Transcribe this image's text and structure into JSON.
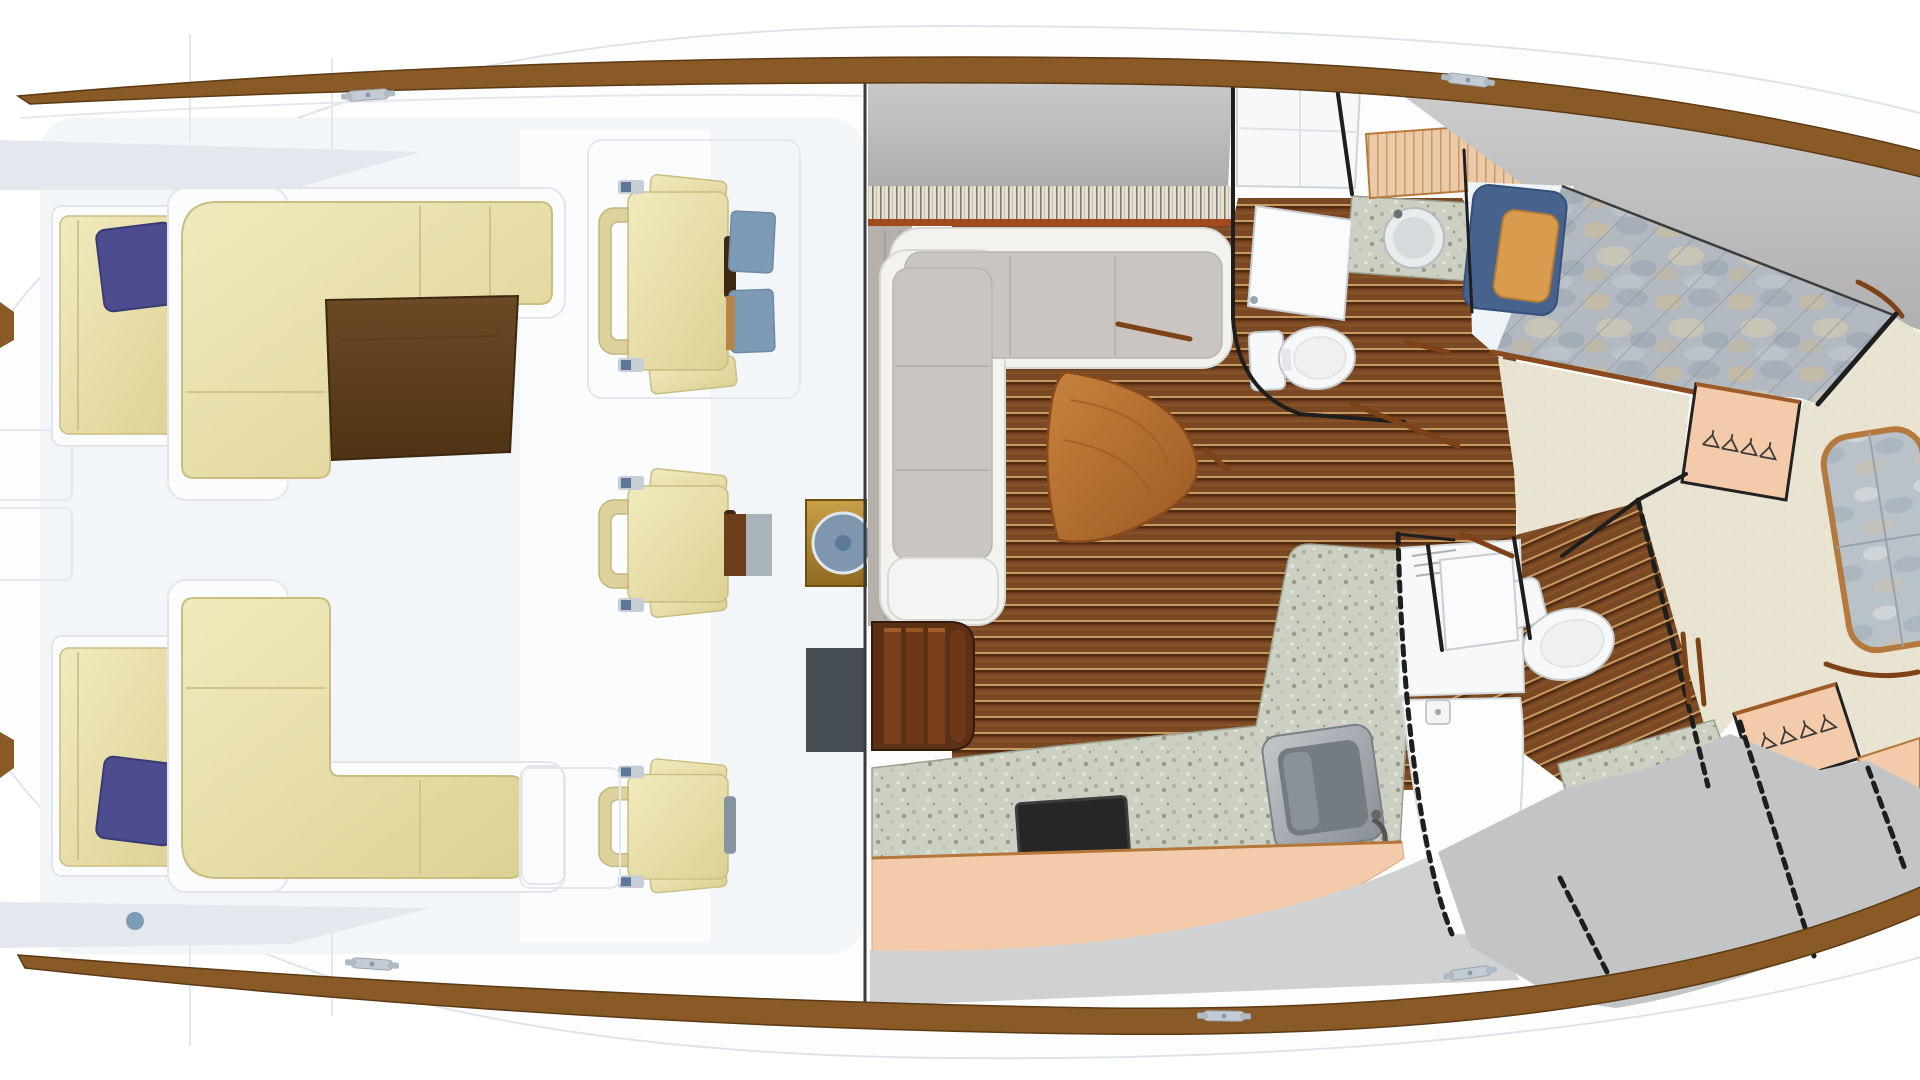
{
  "figure": {
    "kind": "yacht-floorplan",
    "views": [
      {
        "name": "deck-plan",
        "side": "left"
      },
      {
        "name": "interior-plan",
        "side": "right"
      }
    ]
  },
  "palette": {
    "hull_white": "#fdfdfe",
    "deck_tint": "#f3f6f9",
    "deck_shadow": "#e3e8ee",
    "teak_rail": "#8a5a26",
    "teak_rail_dark": "#5e3a14",
    "cushion_cream": "#eae2ac",
    "cushion_cream_deep": "#d9cf96",
    "cushion_edge": "#c9bd82",
    "navy_pillow": "#4c4c8e",
    "steel_blue": "#7e9bb5",
    "table_brown": "#5e3f1e",
    "slate_panel": "#474e54",
    "helm_gold": "#b58934",
    "wheel_blue": "#7e97ae",
    "interior_gray": "#bcbcbd",
    "woven_bg": "#e7e1d1",
    "taupe_wall": "#b5b0ac",
    "settee_white": "#f2f2ef",
    "settee_taupe": "#cbc5c1",
    "wood_plank": "#7a4823",
    "wood_holly": "#c89a60",
    "step_wood": "#5c3014",
    "granite": "#ccd0c2",
    "peach": "#f4cbaa",
    "peach_trim": "#b9783c",
    "carpet": "#e9e4d1",
    "duvet_base": "#b2b9c0",
    "bed_navy": "#47628c",
    "bed_tan": "#d99b4e",
    "fixture_white": "#f7f8f9",
    "fixture_line": "#c5cacd",
    "wall_black": "#1e1e1e",
    "trim_brown": "#7d4218",
    "steel_sink": "#9aa1a7",
    "gray_facet": "#c3c4c6",
    "stove_black": "#262626",
    "cleat_gray": "#c3ccd4"
  },
  "components": {
    "deck": [
      "hull",
      "toe-rail-top",
      "toe-rail-bottom",
      "cleat",
      "side-bench-port",
      "side-bench-starboard",
      "navy-cushion",
      "cockpit-settee-forward",
      "cockpit-settee-aft",
      "cockpit-table",
      "helm-chair-forward",
      "helm-chair-middle",
      "helm-chair-aft",
      "footrest-pad",
      "helm-console",
      "helm-wheel-icon",
      "engine-hatch-panel",
      "deck-light"
    ],
    "interior": [
      "salon-settee",
      "salon-triangle-table",
      "companionway-steps",
      "galley-counter",
      "cooktop",
      "galley-sink",
      "cabinet-front",
      "aft-head-vanity",
      "aft-head-sink",
      "aft-head-toilet",
      "aft-head-door",
      "island-berth",
      "berth-pillow-navy",
      "berth-pillow-tan",
      "berth-duvet",
      "hanging-locker-stateroom",
      "hanging-locker-forward",
      "clothes-hanger-icon",
      "forward-head-shower",
      "forward-head-toilet",
      "forward-head-sink",
      "bow-seat-cushion",
      "grab-rail",
      "bulkhead-wall",
      "woven-blind"
    ]
  }
}
